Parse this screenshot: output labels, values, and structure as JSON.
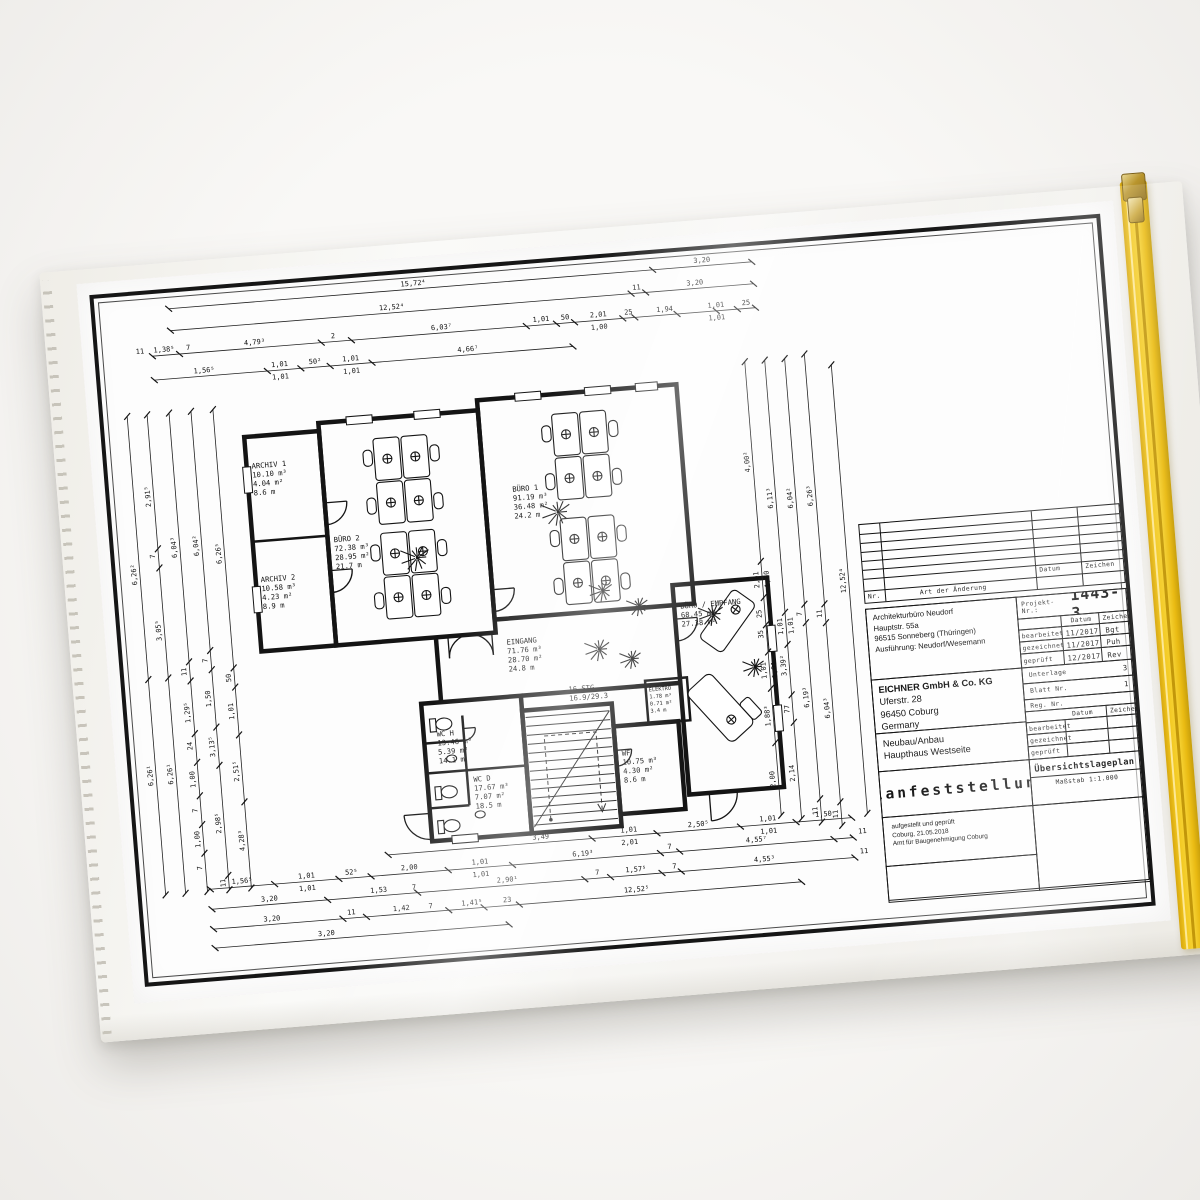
{
  "sleeve": {
    "zipper_color": "#f2c71e",
    "film_tint": "#f3f2ee"
  },
  "titleblock": {
    "rev": {
      "nr_label": "Nr.",
      "art_label": "Art der Änderung",
      "datum_label": "Datum",
      "zeichen_label": "Zeichen"
    },
    "projekt": {
      "label": "Projekt-Nr.:",
      "value": "1443-3"
    },
    "architect_lines": [
      "Architekturbüro Neudorf",
      "Hauptstr. 55a",
      "96515 Sonneberg (Thüringen)",
      "Ausführung: Neudorf/Wesemann"
    ],
    "meta1": {
      "datum_label": "Datum",
      "zeichen_label": "Zeichen",
      "rows": [
        {
          "label": "bearbeitet",
          "datum": "11/2017",
          "zeichen": "Bgt"
        },
        {
          "label": "gezeichnet",
          "datum": "11/2017",
          "zeichen": "Puh"
        },
        {
          "label": "geprüft",
          "datum": "12/2017",
          "zeichen": "Rev"
        }
      ]
    },
    "company_lines": [
      "EICHNER GmbH & Co. KG",
      "Uferstr. 28",
      "96450 Coburg",
      "Germany"
    ],
    "doc_info": {
      "unterlage_label": "Unterlage",
      "unterlage_value": "3",
      "blatt_label": "Blatt Nr.",
      "blatt_value": "1",
      "reg_label": "Reg. Nr.",
      "reg_value": ""
    },
    "project_lines": [
      "Neubau/Anbau",
      "Haupthaus Westseite"
    ],
    "meta2": {
      "datum_label": "Datum",
      "zeichen_label": "Zeichen",
      "rows": [
        "bearbeitet",
        "gezeichnet",
        "geprüft"
      ]
    },
    "title": "Planfeststellung",
    "plan_type": "Übersichtslageplan",
    "scale": "Maßstab 1:1.000",
    "stamp_lines": [
      "aufgestellt und geprüft",
      "Coburg, 21.05.2018",
      "Amt für Baugenehmigung Coburg"
    ]
  },
  "plan": {
    "rooms": [
      {
        "x": 130,
        "y": 182,
        "lines": [
          "ARCHIV 1",
          "10.10 m³",
          "4.04 m²",
          "8.6 m"
        ]
      },
      {
        "x": 130,
        "y": 296,
        "lines": [
          "ARCHIV 2",
          "10.58 m³",
          "4.23 m²",
          "8.9 m"
        ]
      },
      {
        "x": 206,
        "y": 262,
        "lines": [
          "BÜRO 2",
          "72.38 m³",
          "28.95 m²",
          "21.7 m"
        ]
      },
      {
        "x": 388,
        "y": 226,
        "lines": [
          "BÜRO 1",
          "91.19 m³",
          "36.48 m²",
          "24.2 m"
        ]
      },
      {
        "x": 370,
        "y": 378,
        "lines": [
          "EINGANG",
          "71.76 m³",
          "28.70 m²",
          "24.8 m"
        ]
      },
      {
        "x": 293,
        "y": 464,
        "lines": [
          "WC H",
          "13.46 m³",
          "5.39 m²",
          "14.1 m"
        ]
      },
      {
        "x": 326,
        "y": 512,
        "lines": [
          "WC D",
          "17.67 m³",
          "7.07 m²",
          "18.5 m"
        ]
      },
      {
        "x": 476,
        "y": 498,
        "lines": [
          "WF",
          "10.75 m³",
          "4.30 m²",
          "8.6 m"
        ]
      },
      {
        "x": 546,
        "y": 356,
        "lines": [
          "BÜRO / EMPFANG",
          "68.45 m³",
          "27.38 m²"
        ]
      },
      {
        "x": 508,
        "y": 436,
        "lines": [
          "ELEKTRO",
          "1.78 m³",
          "0.71 m²",
          "3.4 m"
        ],
        "small": true
      }
    ],
    "stairs": {
      "x": 428,
      "y": 430,
      "lines": [
        "16 STG",
        "16.9/29.3"
      ]
    },
    "dim_chains": [
      {
        "x1": 60,
        "y1": 16,
        "x2": 645,
        "y2": 16,
        "ticks": [
          0,
          0.83,
          1
        ],
        "labels": [
          {
            "p": 0.42,
            "t": "15,72⁴"
          },
          {
            "p": 0.915,
            "t": "3,20"
          }
        ]
      },
      {
        "x1": 60,
        "y1": 38,
        "x2": 645,
        "y2": 38,
        "ticks": [
          0,
          0.79,
          0.815,
          1
        ],
        "labels": [
          {
            "p": 0.38,
            "t": "12,52⁴"
          },
          {
            "p": 0.8,
            "t": "11"
          },
          {
            "p": 0.9,
            "t": "3,20"
          }
        ]
      },
      {
        "x1": 40,
        "y1": 62,
        "x2": 645,
        "y2": 62,
        "ticks": [
          0,
          0.045,
          0.28,
          0.33,
          0.62,
          0.67,
          0.7,
          0.78,
          0.8,
          0.87,
          0.935,
          0.97,
          1
        ],
        "labels": [
          {
            "p": -0.02,
            "t": "11"
          },
          {
            "p": 0.02,
            "t": "1,38⁵"
          },
          {
            "p": 0.06,
            "t": "7"
          },
          {
            "p": 0.17,
            "t": "4,79³"
          },
          {
            "p": 0.3,
            "t": "2"
          },
          {
            "p": 0.48,
            "t": "6,03⁷"
          },
          {
            "p": 0.645,
            "t": "1,01"
          },
          {
            "p": 0.685,
            "t": "50"
          },
          {
            "p": 0.74,
            "t": "2,01"
          },
          {
            "p": 0.74,
            "t": "1,00",
            "o": 9
          },
          {
            "p": 0.79,
            "t": "25"
          },
          {
            "p": 0.85,
            "t": "1,94"
          },
          {
            "p": 0.935,
            "t": "1,01"
          },
          {
            "p": 0.935,
            "t": "1,01",
            "o": 9
          },
          {
            "p": 0.985,
            "t": "25"
          }
        ]
      },
      {
        "x1": 40,
        "y1": 86,
        "x2": 460,
        "y2": 86,
        "ticks": [
          0,
          0.27,
          0.35,
          0.42,
          0.52,
          1
        ],
        "labels": [
          {
            "p": 0.12,
            "t": "1,56⁵"
          },
          {
            "p": 0.3,
            "t": "1,01"
          },
          {
            "p": 0.3,
            "t": "1,01",
            "o": 9
          },
          {
            "p": 0.385,
            "t": "50²"
          },
          {
            "p": 0.47,
            "t": "1,01"
          },
          {
            "p": 0.47,
            "t": "1,01",
            "o": 9
          },
          {
            "p": 0.75,
            "t": "4,66⁷"
          }
        ]
      },
      {
        "x1": 235,
        "y1": 578,
        "x2": 700,
        "y2": 578,
        "ticks": [
          0,
          0.44,
          0.58,
          0.76,
          0.88,
          1
        ],
        "labels": [
          {
            "p": 0.33,
            "t": "3,49"
          },
          {
            "p": 0.52,
            "t": "1,01"
          },
          {
            "p": 0.52,
            "t": "2,01",
            "o": 9
          },
          {
            "p": 0.67,
            "t": "2,50⁵"
          },
          {
            "p": 0.82,
            "t": "1,01"
          },
          {
            "p": 0.82,
            "t": "1,01",
            "o": 9
          },
          {
            "p": 0.94,
            "t": "1,50"
          }
        ]
      },
      {
        "x1": 55,
        "y1": 598,
        "x2": 700,
        "y2": 598,
        "ticks": [
          0,
          0.1,
          0.2,
          0.25,
          0.37,
          0.47,
          0.7,
          0.73,
          0.97,
          1
        ],
        "labels": [
          {
            "p": 0.05,
            "t": "1,56⁵"
          },
          {
            "p": 0.15,
            "t": "1,01"
          },
          {
            "p": 0.15,
            "t": "1,01",
            "o": 9
          },
          {
            "p": 0.22,
            "t": "52⁵"
          },
          {
            "p": 0.31,
            "t": "2,00"
          },
          {
            "p": 0.42,
            "t": "1,01"
          },
          {
            "p": 0.42,
            "t": "1,01",
            "o": 9
          },
          {
            "p": 0.58,
            "t": "6,19³"
          },
          {
            "p": 0.715,
            "t": "7"
          },
          {
            "p": 0.85,
            "t": "4,55⁷"
          },
          {
            "p": 1.015,
            "t": "11"
          }
        ]
      },
      {
        "x1": 55,
        "y1": 618,
        "x2": 700,
        "y2": 618,
        "ticks": [
          0,
          0.18,
          0.32,
          0.58,
          0.62,
          0.7,
          0.73,
          1
        ],
        "labels": [
          {
            "p": 0.09,
            "t": "3,20"
          },
          {
            "p": 0.26,
            "t": "1,53"
          },
          {
            "p": 0.315,
            "t": "7"
          },
          {
            "p": 0.46,
            "t": "2,90¹"
          },
          {
            "p": 0.6,
            "t": "7"
          },
          {
            "p": 0.66,
            "t": "1,57⁵"
          },
          {
            "p": 0.72,
            "t": "7"
          },
          {
            "p": 0.86,
            "t": "4,55³"
          },
          {
            "p": 1.015,
            "t": "11"
          }
        ]
      },
      {
        "x1": 55,
        "y1": 638,
        "x2": 645,
        "y2": 638,
        "ticks": [
          0,
          0.22,
          0.26,
          0.4,
          0.46,
          0.52,
          1
        ],
        "labels": [
          {
            "p": 0.1,
            "t": "3,20"
          },
          {
            "p": 0.235,
            "t": "11"
          },
          {
            "p": 0.32,
            "t": "1,42"
          },
          {
            "p": 0.37,
            "t": "7"
          },
          {
            "p": 0.44,
            "t": "1,41⁵"
          },
          {
            "p": 0.5,
            "t": "23"
          },
          {
            "p": 0.72,
            "t": "12,52⁵"
          }
        ]
      },
      {
        "x1": 55,
        "y1": 657,
        "x2": 350,
        "y2": 657,
        "ticks": [
          0,
          1
        ],
        "labels": [
          {
            "p": 0.38,
            "t": "3,20"
          }
        ]
      },
      {
        "x1": 10,
        "y1": 600,
        "x2": 10,
        "y2": 120,
        "ticks": [
          0,
          0.45,
          1
        ],
        "labels": [
          {
            "p": 0.67,
            "t": "6,26²"
          },
          {
            "p": 0.25,
            "t": "6,26¹"
          }
        ]
      },
      {
        "x1": 30,
        "y1": 600,
        "x2": 30,
        "y2": 120,
        "ticks": [
          0,
          0.45,
          0.68,
          0.72,
          1
        ],
        "labels": [
          {
            "p": 0.83,
            "t": "2,91⁵"
          },
          {
            "p": 0.705,
            "t": "7"
          },
          {
            "p": 0.55,
            "t": "3,05⁵"
          },
          {
            "p": 0.25,
            "t": "6,26¹"
          }
        ]
      },
      {
        "x1": 52,
        "y1": 600,
        "x2": 52,
        "y2": 120,
        "ticks": [
          0,
          0.08,
          0.14,
          0.2,
          0.27,
          0.33,
          0.44,
          0.48,
          1
        ],
        "labels": [
          {
            "p": 0.72,
            "t": "6,04³"
          },
          {
            "p": 0.46,
            "t": "11"
          },
          {
            "p": 0.375,
            "t": "1,29⁵"
          },
          {
            "p": 0.305,
            "t": "24"
          },
          {
            "p": 0.235,
            "t": "1,00"
          },
          {
            "p": 0.17,
            "t": "7"
          },
          {
            "p": 0.11,
            "t": "1,00"
          },
          {
            "p": 0.05,
            "t": "7"
          }
        ]
      },
      {
        "x1": 74,
        "y1": 600,
        "x2": 74,
        "y2": 120,
        "ticks": [
          0,
          0.03,
          0.26,
          0.34,
          0.46,
          0.5,
          1
        ],
        "labels": [
          {
            "p": 0.72,
            "t": "6,04²"
          },
          {
            "p": 0.48,
            "t": "7"
          },
          {
            "p": 0.4,
            "t": "1,50"
          },
          {
            "p": 0.3,
            "t": "3,13⁵"
          },
          {
            "p": 0.14,
            "t": "2,98⁵"
          },
          {
            "p": 0.015,
            "t": "11"
          }
        ]
      },
      {
        "x1": 96,
        "y1": 600,
        "x2": 96,
        "y2": 120,
        "ticks": [
          0,
          0.18,
          0.32,
          0.42,
          0.46,
          1
        ],
        "labels": [
          {
            "p": 0.7,
            "t": "6,26⁵"
          },
          {
            "p": 0.44,
            "t": "50"
          },
          {
            "p": 0.37,
            "t": "1,01"
          },
          {
            "p": 0.245,
            "t": "2,51⁵"
          },
          {
            "p": 0.1,
            "t": "4,28³"
          }
        ]
      },
      {
        "x1": 630,
        "y1": 570,
        "x2": 630,
        "y2": 115,
        "ticks": [
          0,
          0.16,
          0.28,
          0.36,
          0.42,
          0.48,
          0.56,
          1
        ],
        "labels": [
          {
            "p": 0.78,
            "t": "4,00²"
          },
          {
            "p": 0.52,
            "t": "2,01"
          },
          {
            "p": 0.52,
            "t": "1,00",
            "o": 7
          },
          {
            "p": 0.445,
            "t": "25"
          },
          {
            "p": 0.4,
            "t": "35"
          },
          {
            "p": 0.32,
            "t": "1,01"
          },
          {
            "p": 0.32,
            "t": "1,01",
            "o": 7
          },
          {
            "p": 0.22,
            "t": "1,88³"
          },
          {
            "p": 0.08,
            "t": "2,00"
          }
        ]
      },
      {
        "x1": 650,
        "y1": 575,
        "x2": 650,
        "y2": 115,
        "ticks": [
          0,
          0.21,
          0.27,
          0.38,
          0.45,
          1
        ],
        "labels": [
          {
            "p": 0.7,
            "t": "6,11³"
          },
          {
            "p": 0.42,
            "t": "1,01"
          },
          {
            "p": 0.42,
            "t": "1,01",
            "o": 7
          },
          {
            "p": 0.335,
            "t": "3,39²"
          },
          {
            "p": 0.24,
            "t": "77"
          },
          {
            "p": 0.1,
            "t": "2,14"
          }
        ]
      },
      {
        "x1": 670,
        "y1": 580,
        "x2": 670,
        "y2": 115,
        "ticks": [
          0,
          0.05,
          0.43,
          0.47,
          1
        ],
        "labels": [
          {
            "p": 0.7,
            "t": "6,04²"
          },
          {
            "p": 0.45,
            "t": "7"
          },
          {
            "p": 0.27,
            "t": "6,19³"
          },
          {
            "p": 0.025,
            "t": "11"
          }
        ]
      },
      {
        "x1": 690,
        "y1": 585,
        "x2": 690,
        "y2": 112,
        "ticks": [
          0,
          0.05,
          0.43,
          0.47,
          1
        ],
        "labels": [
          {
            "p": 0.7,
            "t": "6,26³"
          },
          {
            "p": 0.45,
            "t": "11"
          },
          {
            "p": 0.25,
            "t": "6,04³"
          },
          {
            "p": 0.025,
            "t": "11"
          }
        ]
      },
      {
        "x1": 716,
        "y1": 575,
        "x2": 716,
        "y2": 125,
        "ticks": [
          0,
          1
        ],
        "labels": [
          {
            "p": 0.52,
            "t": "12,52⁴"
          }
        ]
      }
    ]
  }
}
